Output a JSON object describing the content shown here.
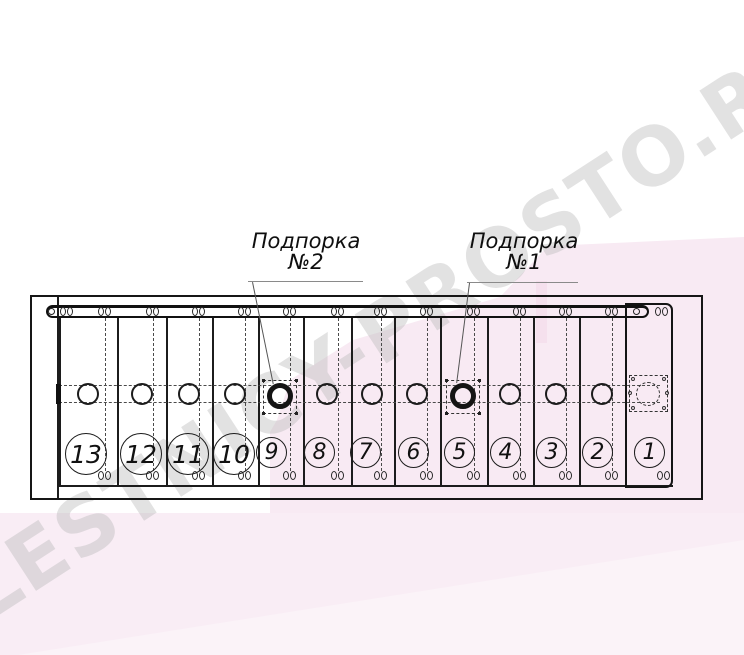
{
  "watermark": {
    "text": "LESTNICY-PROSTO.RU",
    "color": "#c9c9c9"
  },
  "labels": {
    "support2": {
      "line1": "Подпорка",
      "line2": "№2"
    },
    "support1": {
      "line1": "Подпорка",
      "line2": "№1"
    }
  },
  "sections": [
    {
      "label": "13"
    },
    {
      "label": "12"
    },
    {
      "label": "11"
    },
    {
      "label": "10"
    },
    {
      "label": "9"
    },
    {
      "label": "8"
    },
    {
      "label": "7"
    },
    {
      "label": "6"
    },
    {
      "label": "5"
    },
    {
      "label": "4"
    },
    {
      "label": "3"
    },
    {
      "label": "2"
    },
    {
      "label": "1"
    }
  ],
  "colors": {
    "line": "#1c1c1c",
    "pink_band": "#f8eaf3",
    "pink_strip": "#f9edf5",
    "pink_light": "#fbf3f8",
    "pink_accent": "#f4dcea"
  }
}
